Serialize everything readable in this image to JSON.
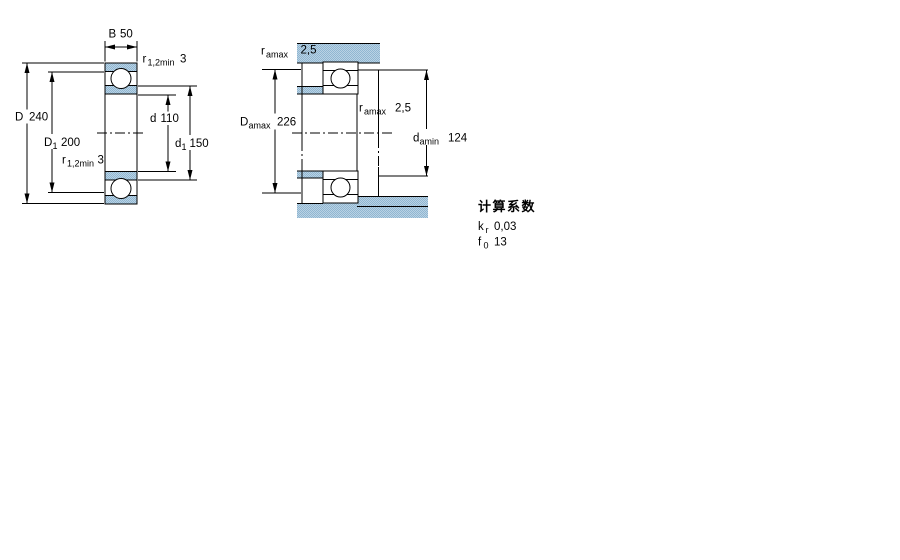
{
  "figure_left": {
    "name": "bearing cross section with boundary dimensions",
    "dim_B": {
      "label": "B",
      "sub": "",
      "value": "50"
    },
    "dim_r_top": {
      "label": "r",
      "sub": "1,2min",
      "value": "3"
    },
    "dim_D": {
      "label": "D",
      "sub": "",
      "value": "240"
    },
    "dim_D1": {
      "label": "D",
      "sub": "1",
      "value": "200"
    },
    "dim_d": {
      "label": "d",
      "sub": "",
      "value": "110"
    },
    "dim_d1": {
      "label": "d",
      "sub": "1",
      "value": "150"
    },
    "dim_r_bottom": {
      "label": "r",
      "sub": "1,2min",
      "value": "3"
    }
  },
  "figure_right": {
    "name": "bearing mounting dimensions with shaft and housing abutments",
    "dim_ra_top": {
      "label": "r",
      "sub": "amax",
      "value": "2,5"
    },
    "dim_Da": {
      "label": "D",
      "sub": "amax",
      "value": "226"
    },
    "dim_ra_mid": {
      "label": "r",
      "sub": "amax",
      "value": "2,5"
    },
    "dim_da": {
      "label": "d",
      "sub": "amin",
      "value": "124"
    }
  },
  "factors": {
    "title": "计算系数",
    "kr": {
      "label": "k",
      "sub": "r",
      "value": "0,03"
    },
    "f0": {
      "label": "f",
      "sub": "0",
      "value": "13"
    }
  },
  "colors": {
    "line": "#000000",
    "steel_light": "#b9d2e4",
    "steel_dark": "#90b6d1",
    "background": "#ffffff"
  }
}
